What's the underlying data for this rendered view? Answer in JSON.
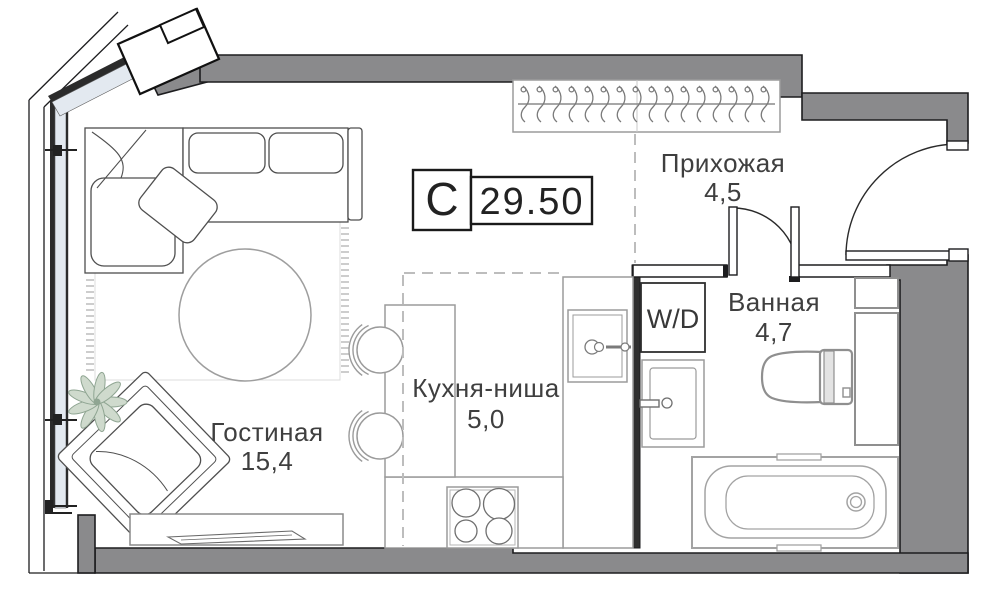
{
  "plan": {
    "badge": {
      "type_letter": "С",
      "area_value": "29.50"
    },
    "rooms": [
      {
        "name": "Гостиная",
        "area": "15,4"
      },
      {
        "name": "Кухня-ниша",
        "area": "5,0"
      },
      {
        "name": "Прихожая",
        "area": "4,5"
      },
      {
        "name": "Ванная",
        "area": "4,7"
      }
    ],
    "appliances": {
      "washer_dryer_label": "W/D"
    },
    "closet": {
      "hanger_count": 16
    },
    "colors": {
      "wall_fill": "#8a8a8c",
      "wall_outline": "#1d1d1f",
      "glazing_fill": "#e3e9f0",
      "zone_dash": "#bdbdbd",
      "text": "#3f3f3f"
    }
  }
}
